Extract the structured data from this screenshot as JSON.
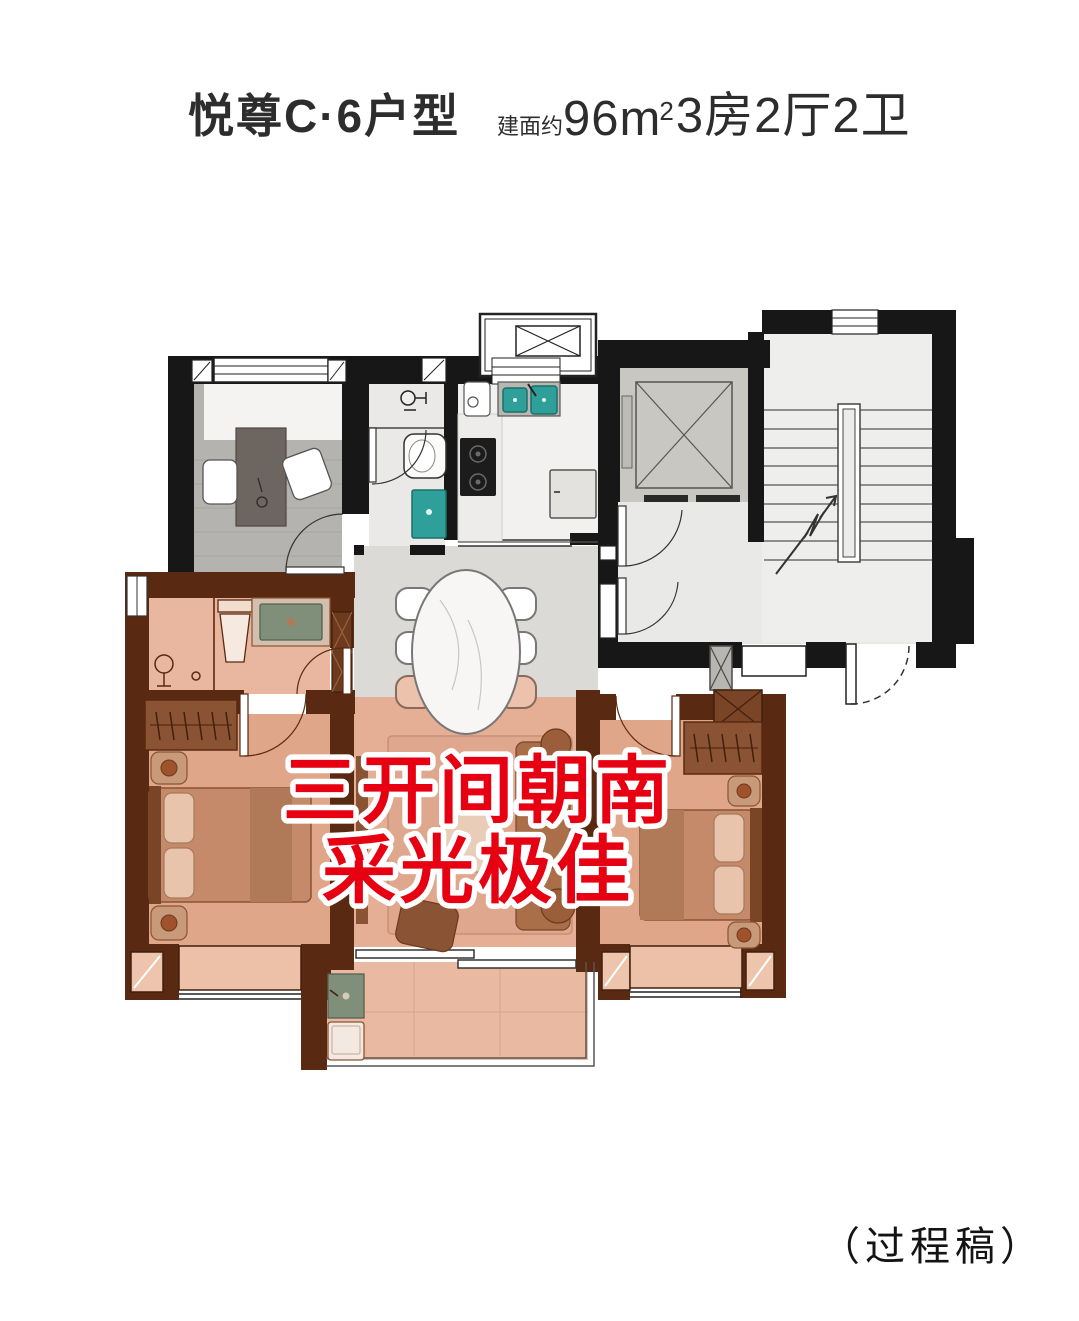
{
  "header": {
    "title": "悦尊C·6户型",
    "area_prefix": "建面约",
    "area_number": "96",
    "area_unit": "m",
    "area_sup": "2",
    "area_rooms": "3房2厅2卫"
  },
  "overlay": {
    "line1": "三开间朝南",
    "line2": "采光极佳"
  },
  "footer": {
    "note": "（过程稿）"
  },
  "colors": {
    "highlight_red": "#e60012",
    "title_black": "#2d2d2d",
    "wall_black": "#171717",
    "wall_brown": "#5a2911",
    "floor_salmon": "#e6b098",
    "floor_wood": "#dfa689",
    "floor_gray_marble": "#dbdad7",
    "floor_light": "#ededeb",
    "fixture_teal": "#2f9f99",
    "vanity_green": "#7f8f79"
  }
}
